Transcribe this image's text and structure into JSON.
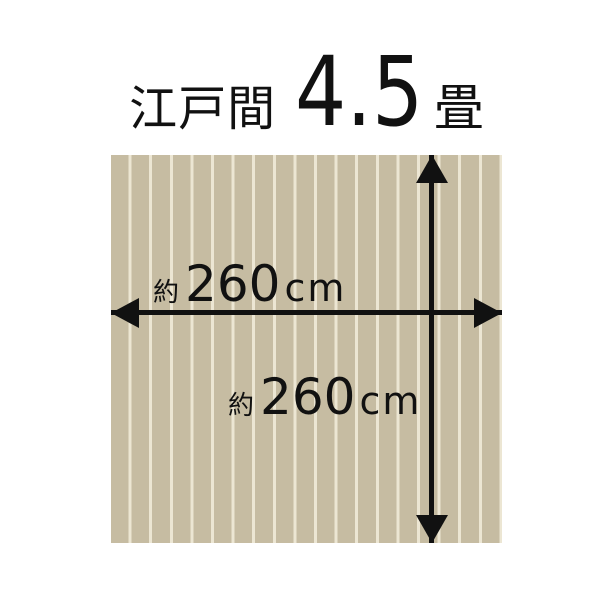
{
  "title": {
    "room_type": "江戸間",
    "size_value": "4.5",
    "size_unit": "畳",
    "full_text": "江戸間 4.5畳"
  },
  "rug": {
    "base_color": "#c6bca2",
    "stripe_color": "#ece6d3",
    "plank_count": 19
  },
  "dimensions": {
    "width": {
      "approx_prefix": "約",
      "value": "260",
      "unit": "cm",
      "label": "約260cm"
    },
    "height": {
      "approx_prefix": "約",
      "value": "260",
      "unit": "cm",
      "label": "約260cm"
    }
  },
  "colors": {
    "text": "#111111",
    "arrow": "#111111",
    "background": "#ffffff"
  }
}
